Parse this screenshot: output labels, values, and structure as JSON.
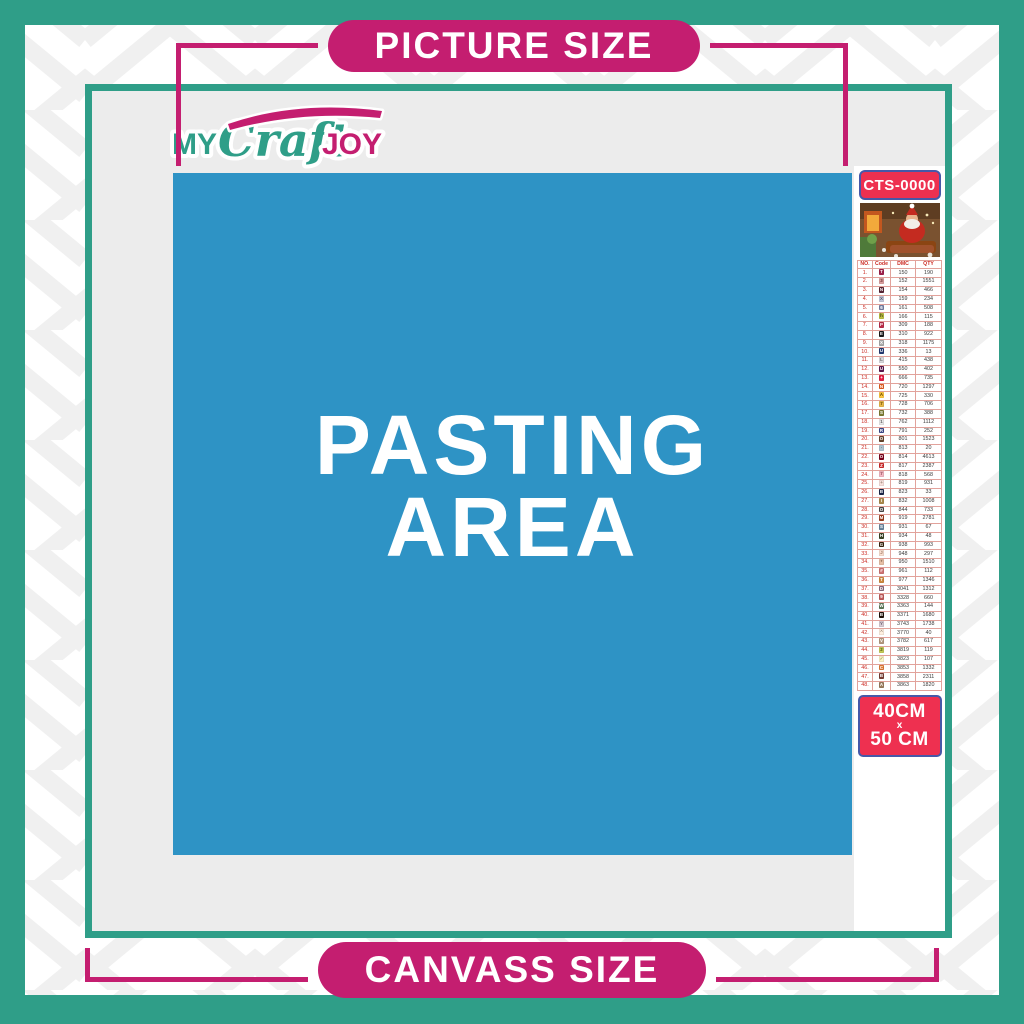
{
  "banners": {
    "top": "PICTURE SIZE",
    "bottom": "CANVASS SIZE"
  },
  "logo": {
    "my": "MY",
    "craft": "Craft",
    "joy": "JOY"
  },
  "pasting_area": {
    "line1": "PASTING",
    "line2": "AREA"
  },
  "product": {
    "code": "CTS-0000",
    "size_top": "40CM",
    "size_sep": "x",
    "size_bottom": "50 CM"
  },
  "colors": {
    "teal": "#2F9E88",
    "magenta": "#C41E70",
    "blue": "#2E93C5",
    "red": "#EE3050",
    "boxborder": "#4758A8",
    "canvasgray": "#ECECEC"
  },
  "color_chart": {
    "headers": [
      "NO.",
      "Code",
      "DMC",
      "QTY"
    ],
    "rows": [
      {
        "no": "1.",
        "sym": "T",
        "chip": "#A0214C",
        "fg": "#ffffff",
        "dmc": "150",
        "qty": "190"
      },
      {
        "no": "2.",
        "sym": "3",
        "chip": "#DCA0A0",
        "fg": "#6b3434",
        "dmc": "152",
        "qty": "1551"
      },
      {
        "no": "3.",
        "sym": "N",
        "chip": "#572433",
        "fg": "#ffffff",
        "dmc": "154",
        "qty": "466"
      },
      {
        "no": "4.",
        "sym": "X",
        "chip": "#C3C8DB",
        "fg": "#555566",
        "dmc": "159",
        "qty": "234"
      },
      {
        "no": "5.",
        "sym": "6",
        "chip": "#7880A4",
        "fg": "#ffffff",
        "dmc": "161",
        "qty": "508"
      },
      {
        "no": "6.",
        "sym": "h",
        "chip": "#BDC044",
        "fg": "#3c3c10",
        "dmc": "166",
        "qty": "115"
      },
      {
        "no": "7.",
        "sym": "P",
        "chip": "#BA2D49",
        "fg": "#ffffff",
        "dmc": "309",
        "qty": "188"
      },
      {
        "no": "8.",
        "sym": "E",
        "chip": "#1A1A1A",
        "fg": "#ffffff",
        "dmc": "310",
        "qty": "922"
      },
      {
        "no": "9.",
        "sym": "X",
        "chip": "#ABABAB",
        "fg": "#ffffff",
        "dmc": "318",
        "qty": "1175"
      },
      {
        "no": "10.",
        "sym": "U",
        "chip": "#253B73",
        "fg": "#ffffff",
        "dmc": "336",
        "qty": "13"
      },
      {
        "no": "11.",
        "sym": "L",
        "chip": "#D9D9DC",
        "fg": "#666666",
        "dmc": "415",
        "qty": "438"
      },
      {
        "no": "12.",
        "sym": "U",
        "chip": "#5C184E",
        "fg": "#ffffff",
        "dmc": "550",
        "qty": "402"
      },
      {
        "no": "13.",
        "sym": "+",
        "chip": "#E31D42",
        "fg": "#ffffff",
        "dmc": "666",
        "qty": "735"
      },
      {
        "no": "14.",
        "sym": "N",
        "chip": "#E55C1F",
        "fg": "#ffffff",
        "dmc": "720",
        "qty": "1297"
      },
      {
        "no": "15.",
        "sym": "A",
        "chip": "#FFC840",
        "fg": "#5a4100",
        "dmc": "725",
        "qty": "330"
      },
      {
        "no": "16.",
        "sym": "7",
        "chip": "#E8B84B",
        "fg": "#5a4100",
        "dmc": "728",
        "qty": "706"
      },
      {
        "no": "17.",
        "sym": "S",
        "chip": "#7D7D34",
        "fg": "#ffffff",
        "dmc": "732",
        "qty": "388"
      },
      {
        "no": "18.",
        "sym": "1",
        "chip": "#E9E9E9",
        "fg": "#666666",
        "dmc": "762",
        "qty": "1112"
      },
      {
        "no": "19.",
        "sym": "R",
        "chip": "#3D4A8C",
        "fg": "#ffffff",
        "dmc": "791",
        "qty": "252"
      },
      {
        "no": "20.",
        "sym": "O",
        "chip": "#65452D",
        "fg": "#ffffff",
        "dmc": "801",
        "qty": "1523"
      },
      {
        "no": "21.",
        "sym": "·",
        "chip": "#AEC3D0",
        "fg": "#44525c",
        "dmc": "813",
        "qty": "20"
      },
      {
        "no": "22.",
        "sym": "O",
        "chip": "#7B001B",
        "fg": "#ffffff",
        "dmc": "814",
        "qty": "4613"
      },
      {
        "no": "23.",
        "sym": "Z",
        "chip": "#CF2B2B",
        "fg": "#ffffff",
        "dmc": "817",
        "qty": "2387"
      },
      {
        "no": "24.",
        "sym": "7",
        "chip": "#F5B8C4",
        "fg": "#84454f",
        "dmc": "818",
        "qty": "568"
      },
      {
        "no": "25.",
        "sym": "+",
        "chip": "#F8E0DD",
        "fg": "#998877",
        "dmc": "819",
        "qty": "931"
      },
      {
        "no": "26.",
        "sym": "B",
        "chip": "#1A2649",
        "fg": "#ffffff",
        "dmc": "823",
        "qty": "33"
      },
      {
        "no": "27.",
        "sym": "I",
        "chip": "#AB8A4C",
        "fg": "#ffffff",
        "dmc": "832",
        "qty": "1008"
      },
      {
        "no": "28.",
        "sym": "O",
        "chip": "#484848",
        "fg": "#ffffff",
        "dmc": "844",
        "qty": "733"
      },
      {
        "no": "29.",
        "sym": "M",
        "chip": "#9A3D1E",
        "fg": "#ffffff",
        "dmc": "919",
        "qty": "2781"
      },
      {
        "no": "30.",
        "sym": "S",
        "chip": "#6A859E",
        "fg": "#ffffff",
        "dmc": "931",
        "qty": "67"
      },
      {
        "no": "31.",
        "sym": "H",
        "chip": "#3B4426",
        "fg": "#ffffff",
        "dmc": "934",
        "qty": "48"
      },
      {
        "no": "32.",
        "sym": "G",
        "chip": "#36220C",
        "fg": "#ffffff",
        "dmc": "938",
        "qty": "993"
      },
      {
        "no": "33.",
        "sym": "J",
        "chip": "#FBE0D0",
        "fg": "#997766",
        "dmc": "948",
        "qty": "297"
      },
      {
        "no": "34.",
        "sym": "*",
        "chip": "#E7BFA5",
        "fg": "#7a5a42",
        "dmc": "950",
        "qty": "1510"
      },
      {
        "no": "35.",
        "sym": "#",
        "chip": "#CF7373",
        "fg": "#ffffff",
        "dmc": "961",
        "qty": "112"
      },
      {
        "no": "36.",
        "sym": "T",
        "chip": "#CE8A3E",
        "fg": "#ffffff",
        "dmc": "977",
        "qty": "1346"
      },
      {
        "no": "37.",
        "sym": "D",
        "chip": "#8A6A7D",
        "fg": "#ffffff",
        "dmc": "3041",
        "qty": "1312"
      },
      {
        "no": "38.",
        "sym": "9",
        "chip": "#C15A5A",
        "fg": "#ffffff",
        "dmc": "3328",
        "qty": "660"
      },
      {
        "no": "39.",
        "sym": "W",
        "chip": "#5F7A5A",
        "fg": "#ffffff",
        "dmc": "3363",
        "qty": "144"
      },
      {
        "no": "40.",
        "sym": "B",
        "chip": "#1E1108",
        "fg": "#ffffff",
        "dmc": "3371",
        "qty": "1680"
      },
      {
        "no": "41.",
        "sym": "Y",
        "chip": "#D7CBD3",
        "fg": "#6f6472",
        "dmc": "3743",
        "qty": "1738"
      },
      {
        "no": "42.",
        "sym": "^",
        "chip": "#FFF0E0",
        "fg": "#998877",
        "dmc": "3770",
        "qty": "40"
      },
      {
        "no": "43.",
        "sym": "V",
        "chip": "#B59A7F",
        "fg": "#ffffff",
        "dmc": "3782",
        "qty": "617"
      },
      {
        "no": "44.",
        "sym": "2",
        "chip": "#C5CC56",
        "fg": "#4c5214",
        "dmc": "3819",
        "qty": "119"
      },
      {
        "no": "45.",
        "sym": "✓",
        "chip": "#FBF4C6",
        "fg": "#999456",
        "dmc": "3823",
        "qty": "107"
      },
      {
        "no": "46.",
        "sym": "C",
        "chip": "#E27B35",
        "fg": "#ffffff",
        "dmc": "3853",
        "qty": "1332"
      },
      {
        "no": "47.",
        "sym": "B",
        "chip": "#7A3F36",
        "fg": "#ffffff",
        "dmc": "3858",
        "qty": "2311"
      },
      {
        "no": "48.",
        "sym": "A",
        "chip": "#9B7E5F",
        "fg": "#ffffff",
        "dmc": "3863",
        "qty": "1820"
      }
    ]
  }
}
